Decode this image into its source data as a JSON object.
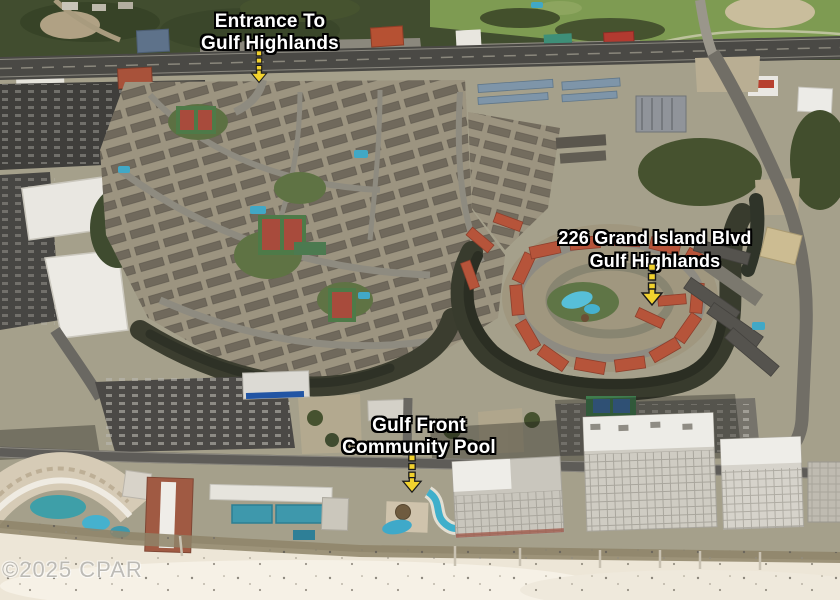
{
  "annotations": {
    "entrance": {
      "line1": "Entrance To",
      "line2": "Gulf Highlands"
    },
    "property": {
      "line1": "226 Grand Island Blvd",
      "line2": "Gulf Highlands"
    },
    "community_pool": {
      "line1": "Gulf Front",
      "line2": "Community Pool"
    }
  },
  "watermark": {
    "text": "©2025 CPAR"
  },
  "colors": {
    "arrow_yellow": "#F2D22E",
    "label_text": "#FFFFFF",
    "label_outline": "#000000",
    "watermark_gray": "#96948E"
  }
}
